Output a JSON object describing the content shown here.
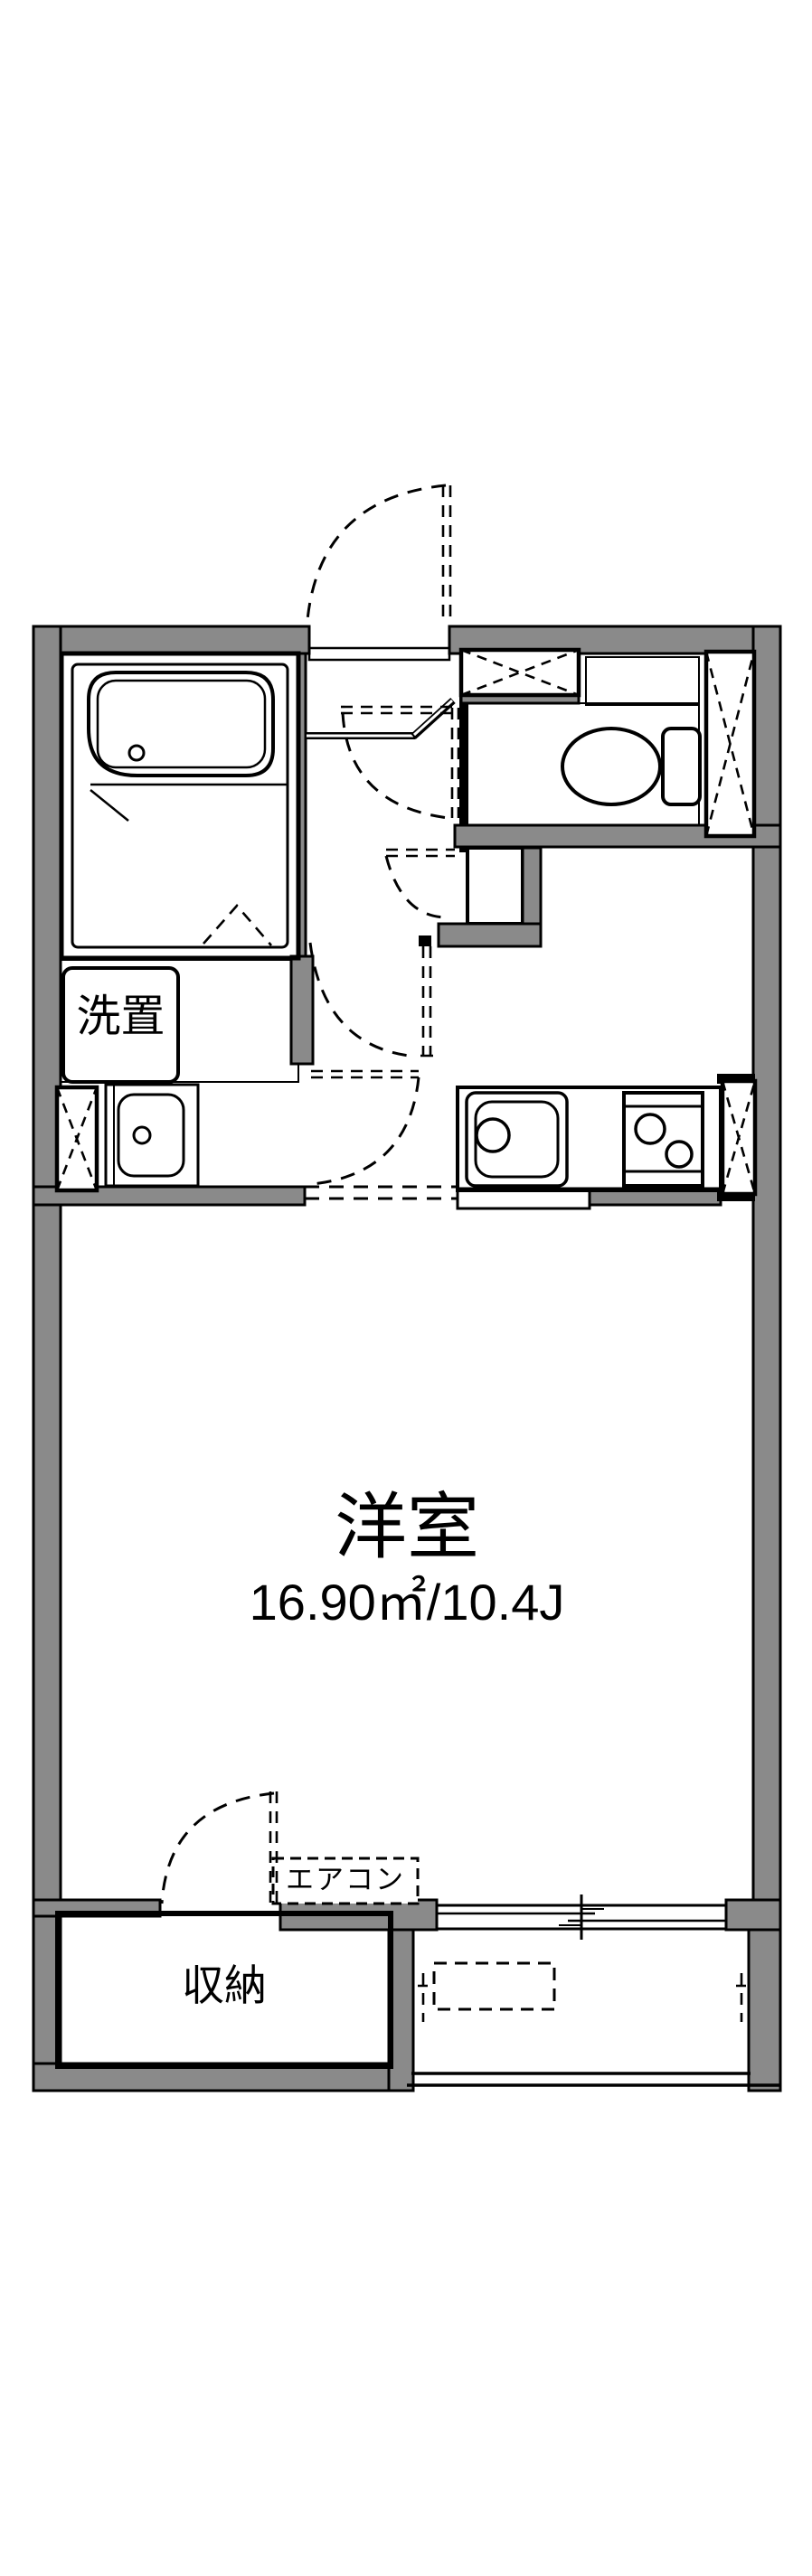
{
  "floorplan": {
    "room_label": "洋室",
    "room_size": "16.90㎡/10.4J",
    "closet_label": "収納",
    "washer_label": "洗置",
    "aircon_label": "エアコン"
  },
  "colors": {
    "bg": "#FFFFFF",
    "wall_gray": "#8A8A8A",
    "fixture_blue": "#DCE8F7",
    "cream": "#FCF2DC",
    "line_black": "#000000"
  }
}
